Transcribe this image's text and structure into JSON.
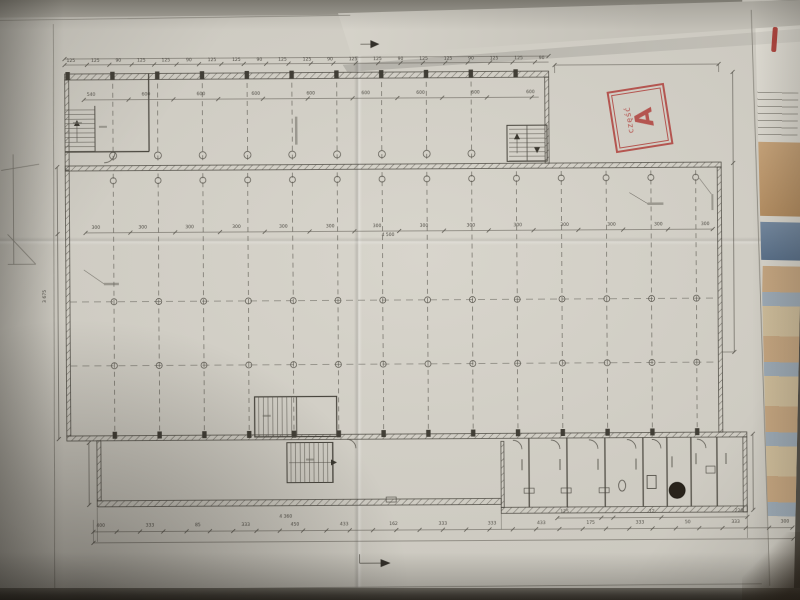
{
  "photo": {
    "stamp": {
      "word": "część",
      "letter": "A",
      "color": "#b0413c"
    },
    "dims": {
      "top_outer": [
        "125",
        "125",
        "90",
        "125",
        "125",
        "90",
        "125",
        "125",
        "90",
        "125",
        "125",
        "90",
        "125",
        "125",
        "90",
        "125",
        "125",
        "90",
        "125",
        "125",
        "90"
      ],
      "top_inner": [
        "540",
        "600",
        "600",
        "600",
        "600",
        "600",
        "600",
        "600",
        "600"
      ],
      "middle": [
        "300",
        "300",
        "300",
        "300",
        "300",
        "300",
        "300",
        "300",
        "300",
        "300",
        "300",
        "300",
        "300",
        "300"
      ],
      "middle_total": "4 500",
      "bottom": [
        "400",
        "333",
        "85",
        "333",
        "450",
        "433",
        "162",
        "333",
        "333",
        "433",
        "175",
        "333",
        "50",
        "333",
        "300"
      ],
      "bottom_total": "4 360",
      "bottom_right": [
        "125",
        "12",
        "228"
      ],
      "left_vertical": "3 675"
    }
  }
}
